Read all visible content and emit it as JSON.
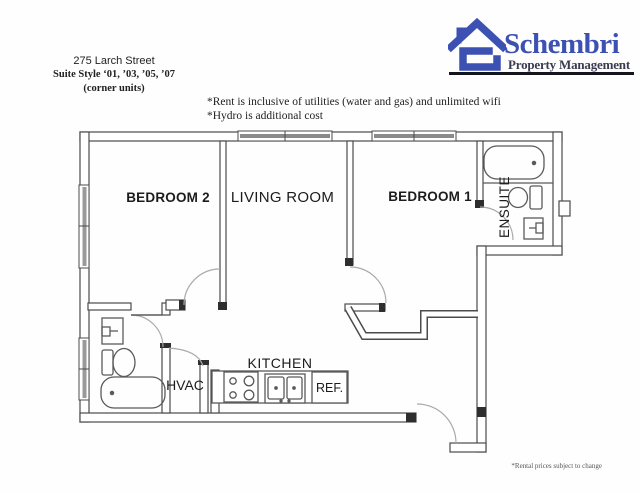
{
  "header": {
    "address": "275 Larch Street",
    "suite_style": "Suite Style ‘01, ’03, ’05, ’07",
    "corner_units": "(corner units)"
  },
  "logo": {
    "name": "Schembri",
    "tagline": "Property Management",
    "brand_blue": "#3c51b2",
    "tagline_color": "#3a3a50"
  },
  "notes": {
    "line1": "*Rent is inclusive of utilities (water and gas) and unlimited wifi",
    "line2": "*Hydro is additional cost"
  },
  "rooms": {
    "bedroom2": "BEDROOM 2",
    "living": "LIVING ROOM",
    "bedroom1": "BEDROOM 1",
    "ensuite": "ENSUITE",
    "kitchen": "KITCHEN",
    "hvac": "HVAC",
    "fridge": "REF."
  },
  "footnote": "*Rental prices subject to change",
  "colors": {
    "wall_line": "#4b4b4b",
    "window_fill": "#8a8a8a",
    "door_arc": "#aaaaaa"
  }
}
